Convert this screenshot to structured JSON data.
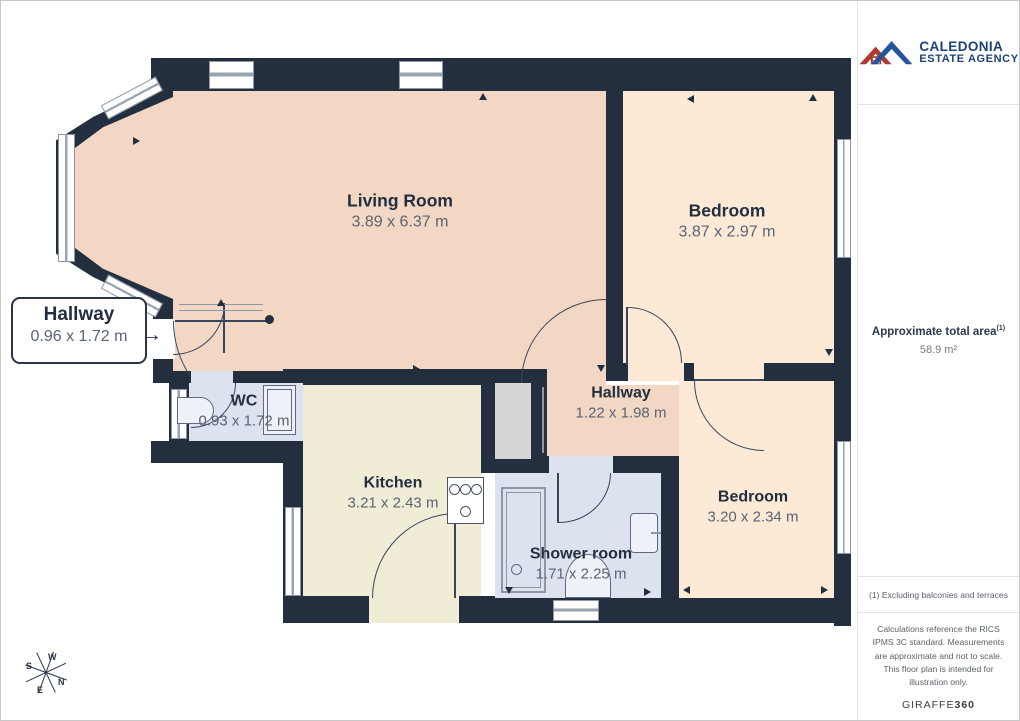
{
  "branding": {
    "line1": "CALEDONIA",
    "line2": "ESTATE AGENCY"
  },
  "panel": {
    "total_area_label": "Approximate total area",
    "total_area_note_ref": "(1)",
    "total_area_value": "58.9 m²",
    "footnote": "(1) Excluding balconies and terraces",
    "disclaimer": "Calculations reference the RICS IPMS 3C standard. Measurements are approximate and not to scale. This floor plan is intended for illustration only.",
    "provider": {
      "name": "GIRAFFE",
      "suffix": "360"
    }
  },
  "callout": {
    "name": "Hallway",
    "dims": "0.96 x 1.72 m",
    "arrow": "→"
  },
  "rooms": {
    "living": {
      "name": "Living Room",
      "dims": "3.89 x 6.37 m"
    },
    "bedroom1": {
      "name": "Bedroom",
      "dims": "3.87 x 2.97 m"
    },
    "wc": {
      "name": "WC",
      "dims": "0.93 x 1.72 m"
    },
    "kitchen": {
      "name": "Kitchen",
      "dims": "3.21 x 2.43 m"
    },
    "hallway2": {
      "name": "Hallway",
      "dims": "1.22 x 1.98 m"
    },
    "shower": {
      "name": "Shower room",
      "dims": "1.71 x 2.25 m"
    },
    "bedroom2": {
      "name": "Bedroom",
      "dims": "3.20 x 2.34 m"
    }
  },
  "compass": {
    "n": "N",
    "e": "E",
    "s": "S",
    "w": "W"
  },
  "colors": {
    "wall": "#232f3f",
    "living": "#f2d7c4",
    "bedroom": "#fcead6",
    "kitchen": "#f1ecd5",
    "wet_room": "#dde2ef",
    "closet": "#d5d5d5",
    "logo_red": "#b03a32",
    "logo_blue": "#24549c",
    "logo_text": "#1d4077"
  }
}
